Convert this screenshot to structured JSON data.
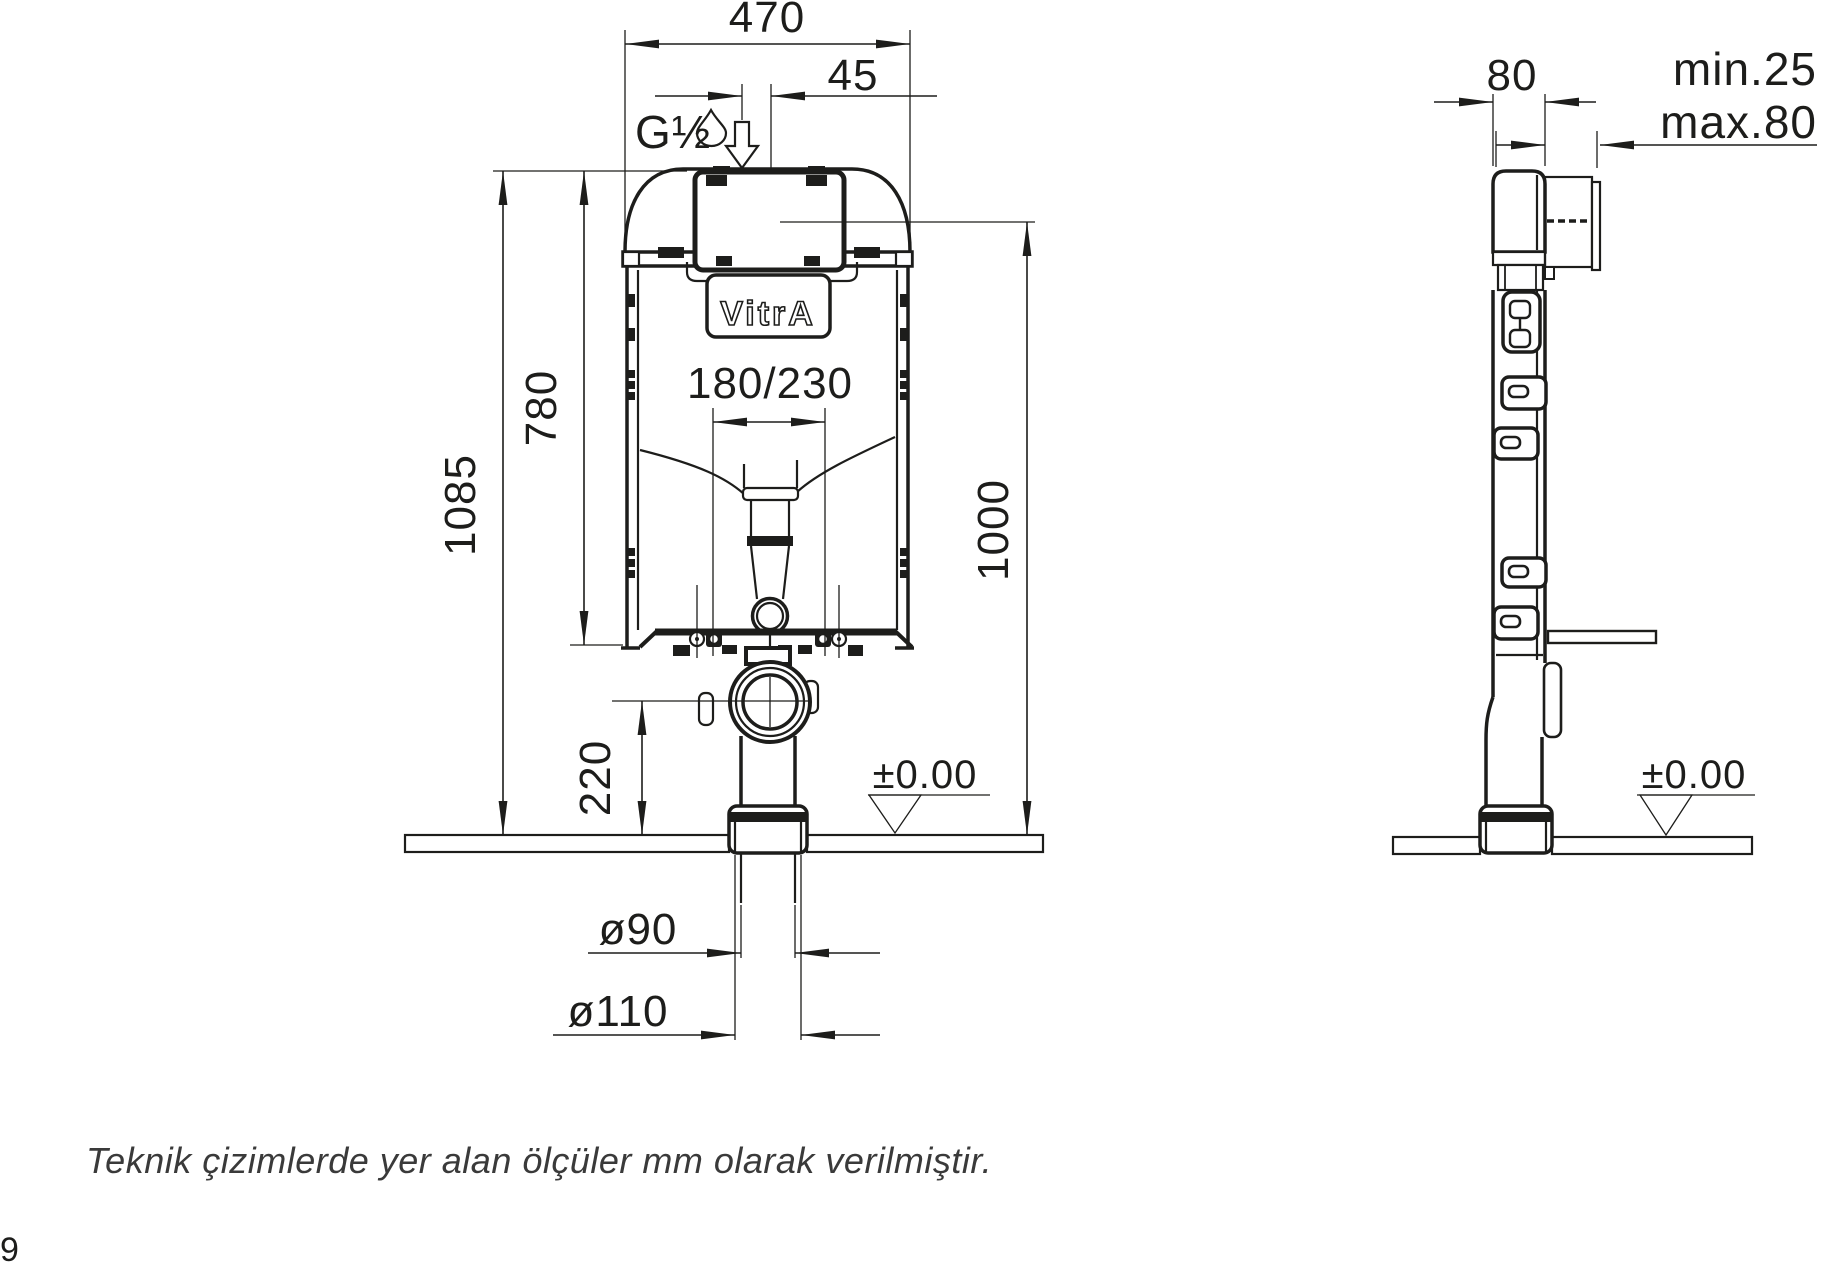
{
  "drawing": {
    "title_hint": "concealed cistern technical drawing",
    "front_view": {
      "dim_width": "470",
      "dim_inlet_offset": "45",
      "inlet_thread": "G½",
      "dim_tank_height": "780",
      "dim_total_height": "1085",
      "dim_bolt_spacing": "180/230",
      "dim_panel_height": "1000",
      "dim_outlet_height": "220",
      "level_label": "±0.00",
      "dim_pipe_inner": "ø90",
      "dim_pipe_outer": "ø110",
      "logo": "VitrA"
    },
    "side_view": {
      "dim_depth": "80",
      "dim_wall_min": "min.25",
      "dim_wall_max": "max.80",
      "level_label": "±0.00"
    },
    "footnote": "Teknik çizimlerde yer alan ölçüler mm olarak verilmiştir.",
    "page_fragment": "9"
  },
  "colors": {
    "line": "#1d1d1b",
    "footnote_text": "#3a3a3a",
    "background": "#ffffff"
  }
}
